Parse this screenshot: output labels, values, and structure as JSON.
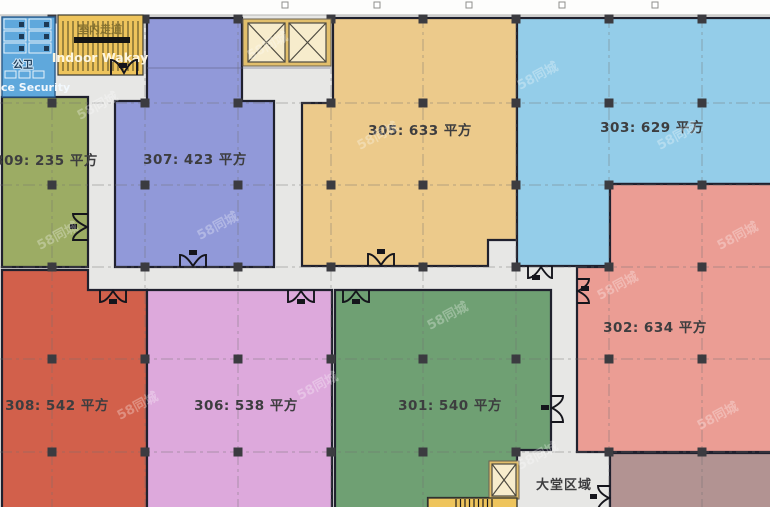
{
  "floorplan": {
    "watermark": "58同城",
    "facilities": {
      "restroom_label_cn": "公卫",
      "restroom_label_en": "ce Security",
      "walkway_label_cn": "室内走道",
      "walkway_label_en": "Indoor Wakay",
      "lobby_label": "大堂区域"
    },
    "rooms": [
      {
        "id": "309",
        "area_sqm": 235,
        "label": "309: 235 平方",
        "color": "#9cac64"
      },
      {
        "id": "307",
        "area_sqm": 423,
        "label": "307: 423 平方",
        "color": "#9199d9"
      },
      {
        "id": "305",
        "area_sqm": 633,
        "label": "305: 633 平方",
        "color": "#ecca8b"
      },
      {
        "id": "303",
        "area_sqm": 629,
        "label": "303: 629 平方",
        "color": "#94cde9"
      },
      {
        "id": "302",
        "area_sqm": 634,
        "label": "302: 634 平方",
        "color": "#eb9d94"
      },
      {
        "id": "308",
        "area_sqm": 542,
        "label": "308: 542 平方",
        "color": "#d2604b"
      },
      {
        "id": "306",
        "area_sqm": 538,
        "label": "306: 538 平方",
        "color": "#dda9dc"
      },
      {
        "id": "301",
        "area_sqm": 540,
        "label": "301: 540 平方",
        "color": "#6fa073"
      }
    ],
    "colors": {
      "corridor": "#e7e7e5",
      "wall": "#20212e",
      "restroom_fill": "#5fa8dc",
      "walkway_fill": "#eec45c",
      "stairs_fill": "#eec45c",
      "elevator_fill": "#f7eccc",
      "elevator_frame": "#e2bf6c",
      "unlabeled_room_fill": "#b29392"
    }
  }
}
